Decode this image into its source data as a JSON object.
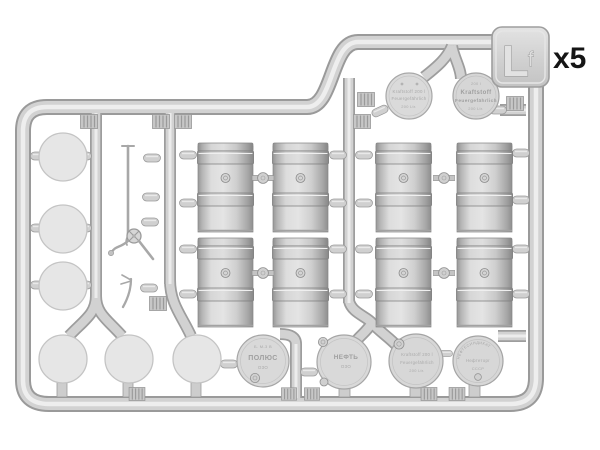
{
  "labels": {
    "quantity": "x5",
    "sprue_letter": "L",
    "sprue_letter_small": "f"
  },
  "embossed_lids": {
    "top": [
      {
        "lines": [
          "Kraftstoff 200 l",
          "Feuergefährlich",
          "200 Ltr."
        ]
      },
      {
        "lines": [
          "200 l",
          "Kraftstoff",
          "Feuergefährlich",
          "200 Ltr."
        ]
      }
    ],
    "bottom": [
      {
        "lines": [
          "Б. М-3 В",
          "ПОЛЮС",
          "О3О"
        ]
      },
      {
        "lines": [
          "НЕФТЬ",
          "О3О"
        ]
      },
      {
        "lines": [
          "Kraftstoff 200 l",
          "Feuergefährlich",
          "200 Ltr."
        ]
      },
      {
        "arc_text": "НЕФТЕСИНДИКАТ",
        "lines": [
          "Нефтеторг",
          "СССР"
        ]
      }
    ]
  },
  "parts_summary": {
    "drum_half_shells": 8,
    "plain_drum_ends": 6,
    "embossed_drum_lids": 6,
    "small_pump_parts": 3
  },
  "colors": {
    "background": "#ffffff",
    "plastic_light": "#eeeeee",
    "plastic_mid": "#d2d2d2",
    "plastic_dark": "#9a9a9a",
    "label_text": "#151515"
  }
}
